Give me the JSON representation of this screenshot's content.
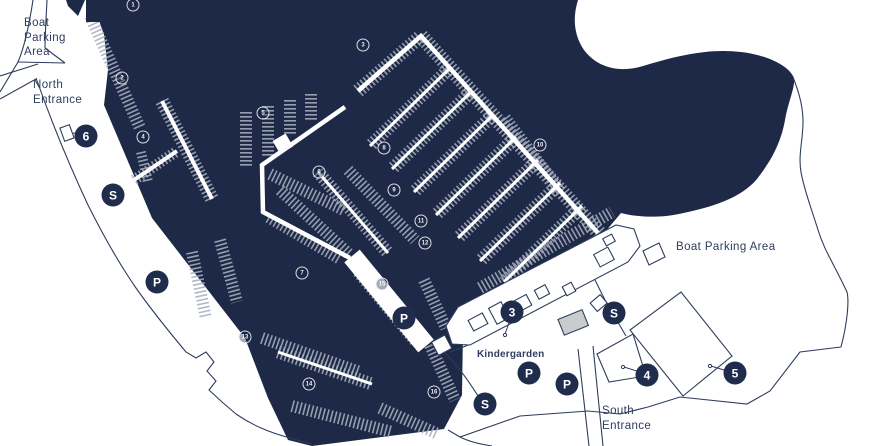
{
  "map": {
    "title_fragment": "E",
    "colors": {
      "water": "#1d2946",
      "land": "#ffffff",
      "outline": "#2e3c5c",
      "boats": "#a6aebe",
      "marker_fill": "#202c4c",
      "marker_text": "#ffffff",
      "building_gray": "#c9cbcd"
    },
    "labels": {
      "boat_parking_nw": {
        "text": "Boat\nParking\nArea"
      },
      "north_entrance": {
        "text": "North\nEntrance"
      },
      "boat_parking_e": {
        "text": "Boat Parking Area"
      },
      "south_entrance": {
        "text": "South\nEntrance"
      },
      "kindergarden": {
        "text": "Kindergarden"
      }
    },
    "markers": [
      {
        "key": "marker-6",
        "label": "6",
        "x": 86,
        "y": 136
      },
      {
        "key": "marker-s-north",
        "label": "S",
        "x": 113,
        "y": 195
      },
      {
        "key": "marker-p-west",
        "label": "P",
        "x": 157,
        "y": 282
      },
      {
        "key": "marker-p-pier",
        "label": "P",
        "x": 404,
        "y": 318
      },
      {
        "key": "marker-3",
        "label": "3",
        "x": 512,
        "y": 312
      },
      {
        "key": "marker-s-east",
        "label": "S",
        "x": 614,
        "y": 313
      },
      {
        "key": "marker-p-kindergarden",
        "label": "P",
        "x": 529,
        "y": 373
      },
      {
        "key": "marker-p-south",
        "label": "P",
        "x": 567,
        "y": 384
      },
      {
        "key": "marker-s-south",
        "label": "S",
        "x": 485,
        "y": 404
      },
      {
        "key": "marker-4",
        "label": "4",
        "x": 647,
        "y": 375
      },
      {
        "key": "marker-5",
        "label": "5",
        "x": 735,
        "y": 373
      }
    ],
    "pier_markers": [
      {
        "label": "1",
        "x": 133,
        "y": 5
      },
      {
        "label": "2",
        "x": 122,
        "y": 78
      },
      {
        "label": "3",
        "x": 363,
        "y": 45
      },
      {
        "label": "4",
        "x": 143,
        "y": 137
      },
      {
        "label": "5",
        "x": 263,
        "y": 113
      },
      {
        "label": "6",
        "x": 319,
        "y": 172
      },
      {
        "label": "7",
        "x": 302,
        "y": 273
      },
      {
        "label": "8",
        "x": 384,
        "y": 148
      },
      {
        "label": "9",
        "x": 394,
        "y": 190
      },
      {
        "label": "10",
        "x": 540,
        "y": 145
      },
      {
        "label": "11",
        "x": 421,
        "y": 221
      },
      {
        "label": "12",
        "x": 425,
        "y": 243
      },
      {
        "label": "13",
        "x": 245,
        "y": 337
      },
      {
        "label": "14",
        "x": 309,
        "y": 384
      },
      {
        "label": "15",
        "x": 382,
        "y": 284
      },
      {
        "label": "16",
        "x": 434,
        "y": 392
      }
    ]
  }
}
